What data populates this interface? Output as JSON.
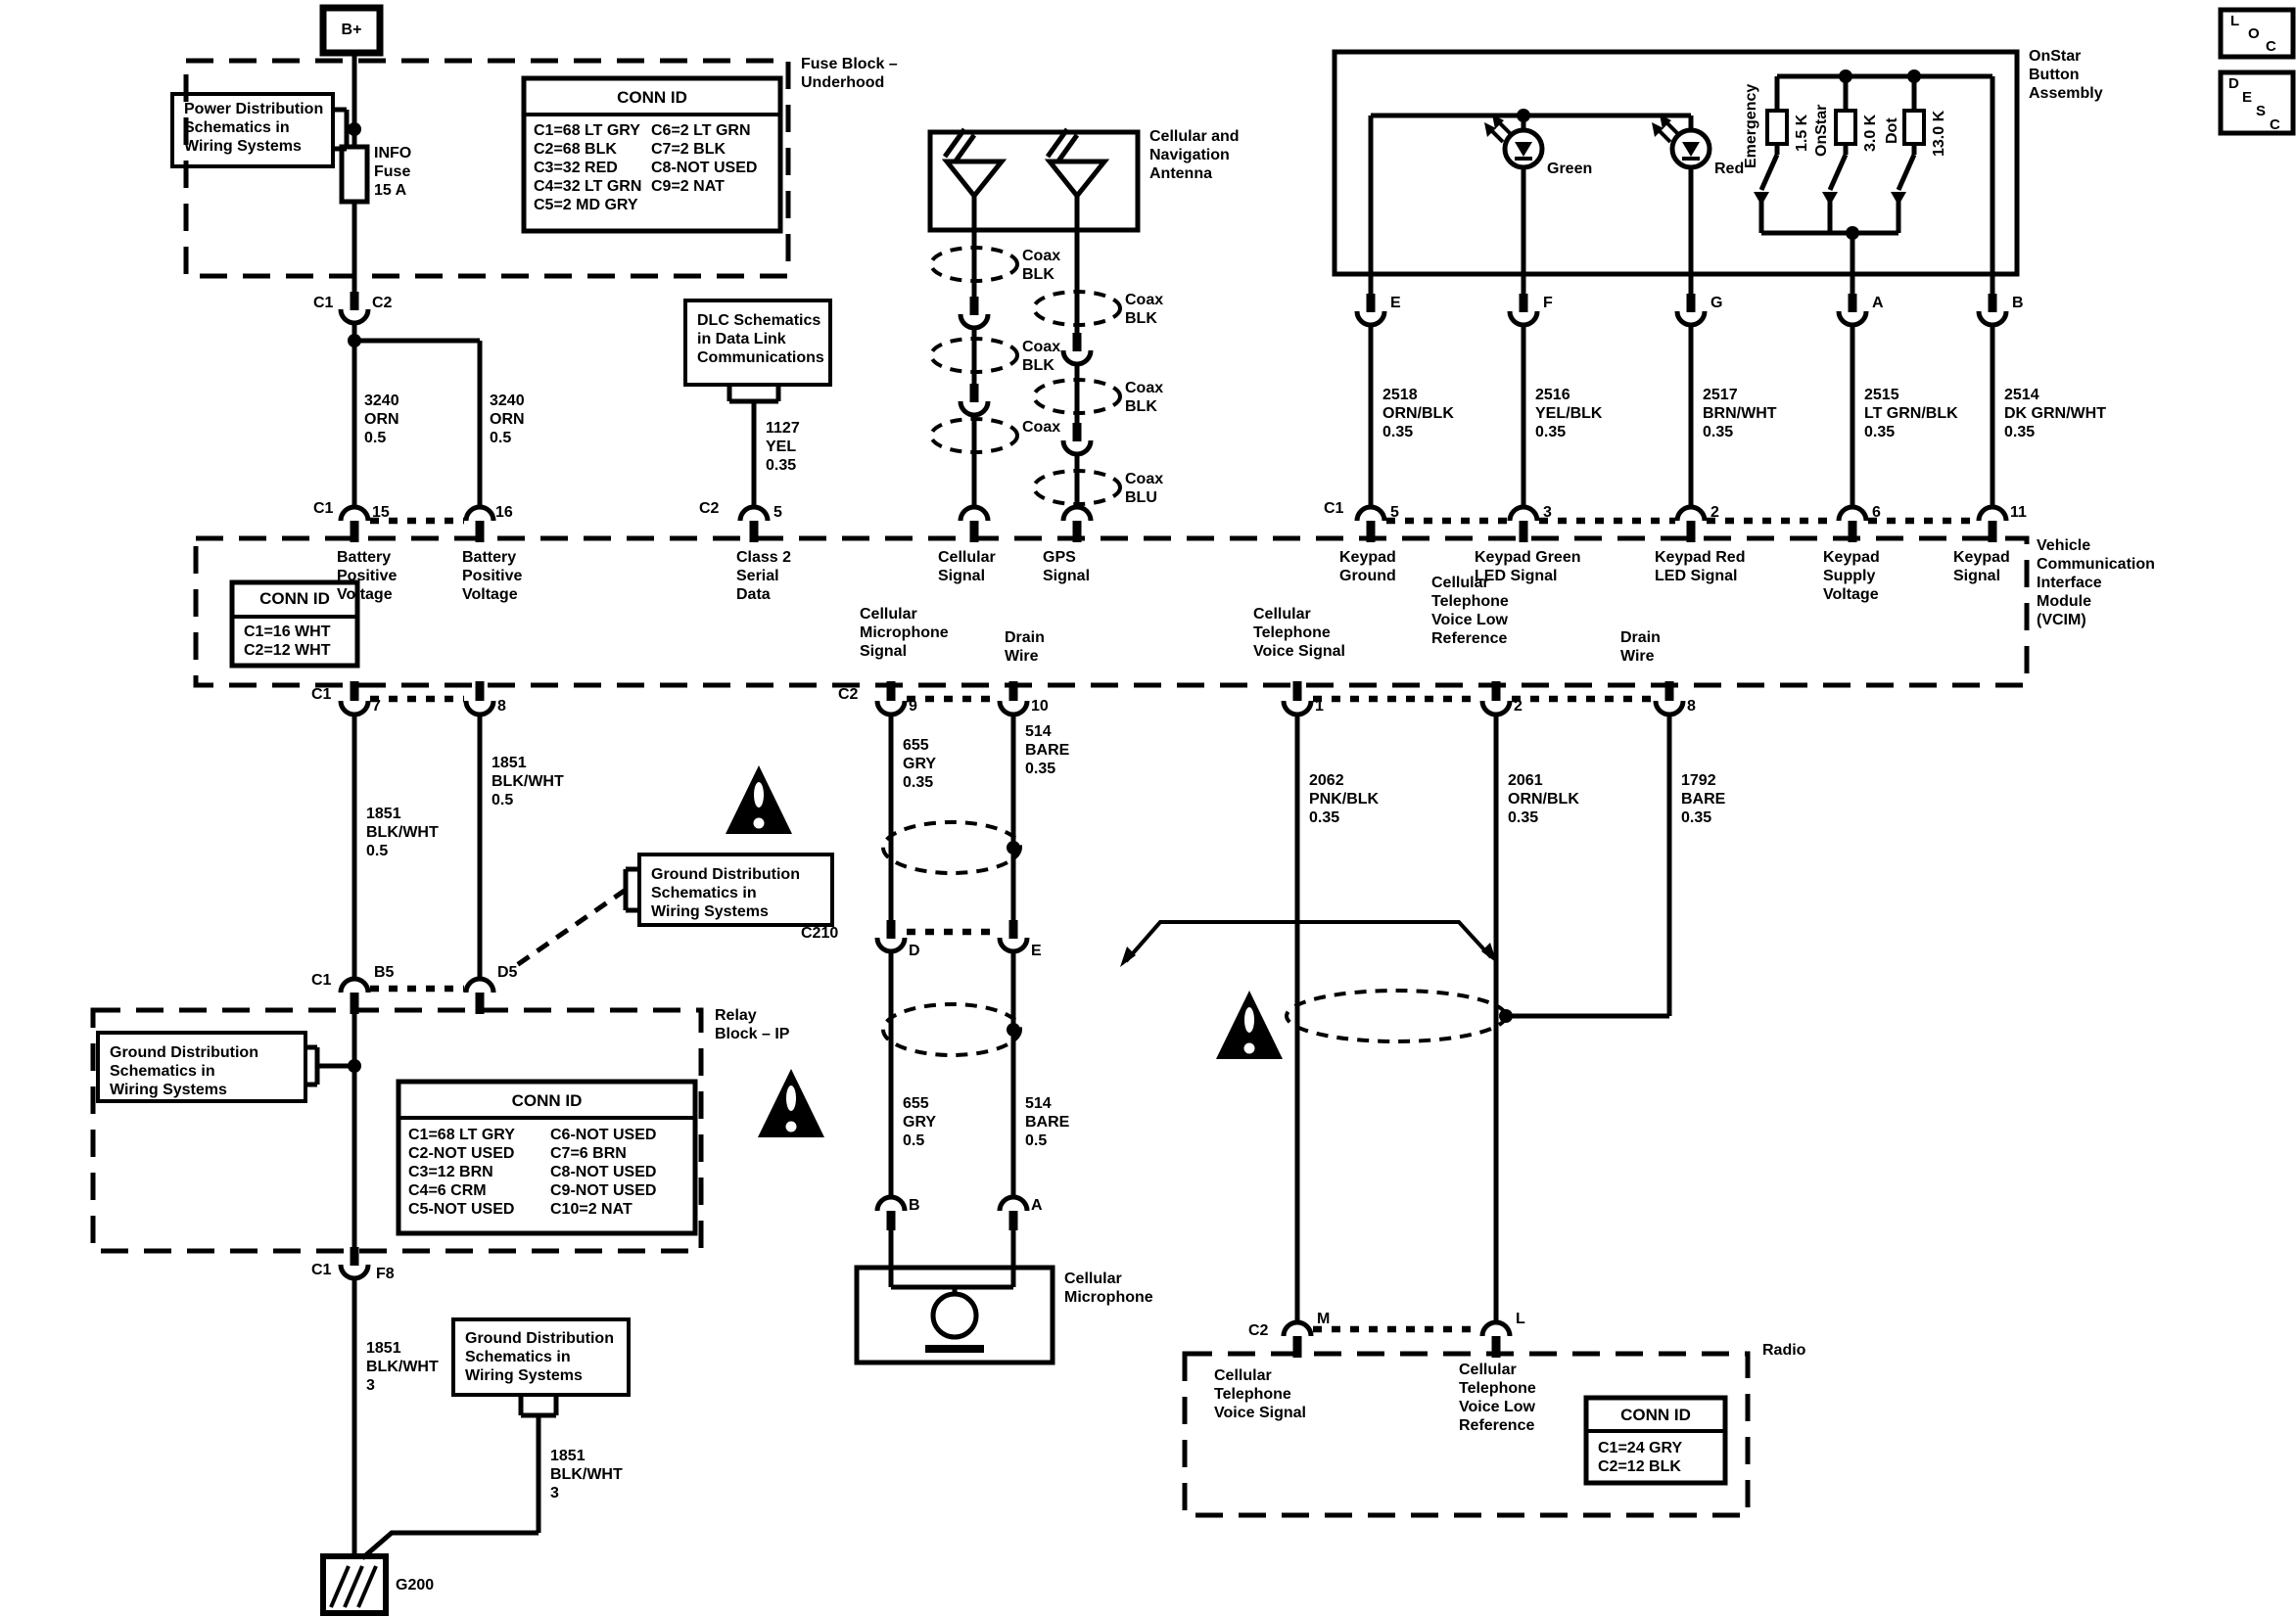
{
  "page": {
    "background": "#ffffff",
    "ink": "#000000"
  },
  "corner": {
    "loc": [
      "L",
      "O",
      "C"
    ],
    "desc": [
      "D",
      "E",
      "S",
      "C"
    ]
  },
  "battery": {
    "bplus": "B+",
    "power_note": [
      "Power Distribution",
      "Schematics in",
      "Wiring Systems"
    ],
    "fuse": [
      "INFO",
      "Fuse",
      "15 A"
    ],
    "fuse_block": [
      "Fuse Block –",
      "Underhood"
    ],
    "conn": {
      "title": "CONN ID",
      "col1": [
        "C1=68 LT GRY",
        "C2=68 BLK",
        "C3=32 RED",
        "C4=32 LT GRN",
        "C5=2 MD GRY"
      ],
      "col2": [
        "C6=2 LT GRN",
        "C7=2 BLK",
        "C8-NOT USED",
        "C9=2 NAT"
      ]
    },
    "c1": "C1",
    "c2": "C2",
    "wire_left": [
      "3240",
      "ORN",
      "0.5"
    ],
    "wire_right": [
      "3240",
      "ORN",
      "0.5"
    ]
  },
  "dlc": {
    "note": [
      "DLC Schematics",
      "in Data Link",
      "Communications"
    ],
    "wire": [
      "1127",
      "YEL",
      "0.35"
    ]
  },
  "antenna": {
    "title": [
      "Cellular and",
      "Navigation",
      "Antenna"
    ],
    "coax_left": [
      [
        "Coax",
        "BLK"
      ],
      [
        "Coax",
        "BLK"
      ],
      [
        "Coax"
      ]
    ],
    "coax_right": [
      [
        "Coax",
        "BLK"
      ],
      [
        "Coax",
        "BLK"
      ],
      [
        "Coax",
        "BLU"
      ]
    ]
  },
  "onstar": {
    "title": [
      "OnStar",
      "Button",
      "Assembly"
    ],
    "green": "Green",
    "red": "Red",
    "switches": [
      "Emergency",
      "OnStar",
      "Dot"
    ],
    "resistors": [
      "1.5 K",
      "3.0 K",
      "13.0 K"
    ],
    "pins": [
      "E",
      "F",
      "G",
      "A",
      "B"
    ],
    "wires": [
      [
        "2518",
        "ORN/BLK",
        "0.35"
      ],
      [
        "2516",
        "YEL/BLK",
        "0.35"
      ],
      [
        "2517",
        "BRN/WHT",
        "0.35"
      ],
      [
        "2515",
        "LT GRN/BLK",
        "0.35"
      ],
      [
        "2514",
        "DK GRN/WHT",
        "0.35"
      ]
    ]
  },
  "vcim": {
    "name": [
      "Vehicle",
      "Communication",
      "Interface",
      "Module",
      "(VCIM)"
    ],
    "conn": {
      "title": "CONN ID",
      "rows": [
        "C1=16 WHT",
        "C2=12 WHT"
      ]
    },
    "top_pins": {
      "c1a": "C1",
      "p15": "15",
      "p16": "16",
      "c2a": "C2",
      "p5": "5",
      "c1b": "C1",
      "p5b": "5",
      "p3": "3",
      "p2": "2",
      "p6": "6",
      "p11": "11"
    },
    "top_signals": {
      "batt1": [
        "Battery",
        "Positive",
        "Voltage"
      ],
      "batt2": [
        "Battery",
        "Positive",
        "Voltage"
      ],
      "class2": [
        "Class 2",
        "Serial",
        "Data"
      ],
      "cell": [
        "Cellular",
        "Signal"
      ],
      "gps": [
        "GPS",
        "Signal"
      ],
      "kground": [
        "Keypad",
        "Ground"
      ],
      "kgreen": [
        "Keypad Green",
        "LED Signal"
      ],
      "kred": [
        "Keypad Red",
        "LED Signal"
      ],
      "ksupply": [
        "Keypad",
        "Supply",
        "Voltage"
      ],
      "ksignal": [
        "Keypad",
        "Signal"
      ]
    },
    "bottom_pins": {
      "c1c": "C1",
      "p7": "7",
      "p8": "8",
      "c2b": "C2",
      "p9": "9",
      "p10": "10",
      "p1": "1",
      "p2b": "2",
      "p8b": "8"
    },
    "bottom_signals": {
      "micsig": [
        "Cellular",
        "Microphone",
        "Signal"
      ],
      "drain1": [
        "Drain",
        "Wire"
      ],
      "voicesig": [
        "Cellular",
        "Telephone",
        "Voice Signal"
      ],
      "voicelow": [
        "Cellular",
        "Telephone",
        "Voice Low",
        "Reference"
      ],
      "drain2": [
        "Drain",
        "Wire"
      ]
    }
  },
  "ground": {
    "wire_7": [
      "1851",
      "BLK/WHT",
      "0.5"
    ],
    "wire_8": [
      "1851",
      "BLK/WHT",
      "0.5"
    ],
    "note_mid": [
      "Ground Distribution",
      "Schematics in",
      "Wiring Systems"
    ],
    "c1d": "C1",
    "b5": "B5",
    "d5": "D5",
    "note_left": [
      "Ground Distribution",
      "Schematics in",
      "Wiring Systems"
    ],
    "relay": [
      "Relay",
      "Block – IP"
    ],
    "conn": {
      "title": "CONN ID",
      "col1": [
        "C1=68 LT GRY",
        "C2-NOT USED",
        "C3=12 BRN",
        "C4=6 CRM",
        "C5-NOT USED"
      ],
      "col2": [
        "C6-NOT USED",
        "C7=6 BRN",
        "C8-NOT USED",
        "C9-NOT USED",
        "C10=2 NAT"
      ]
    },
    "c1e": "C1",
    "f8": "F8",
    "wire_f8": [
      "1851",
      "BLK/WHT",
      "3"
    ],
    "note_bottom": [
      "Ground Distribution",
      "Schematics in",
      "Wiring Systems"
    ],
    "wire_note": [
      "1851",
      "BLK/WHT",
      "3"
    ],
    "g200": "G200"
  },
  "mic": {
    "wire_655a": [
      "655",
      "GRY",
      "0.35"
    ],
    "wire_514a": [
      "514",
      "BARE",
      "0.35"
    ],
    "c210": "C210",
    "d": "D",
    "e": "E",
    "wire_655b": [
      "655",
      "GRY",
      "0.5"
    ],
    "wire_514b": [
      "514",
      "BARE",
      "0.5"
    ],
    "b": "B",
    "a": "A",
    "title": [
      "Cellular",
      "Microphone"
    ]
  },
  "radio": {
    "wire_2062": [
      "2062",
      "PNK/BLK",
      "0.35"
    ],
    "wire_2061": [
      "2061",
      "ORN/BLK",
      "0.35"
    ],
    "wire_1792": [
      "1792",
      "BARE",
      "0.35"
    ],
    "c2c": "C2",
    "m": "M",
    "l": "L",
    "title": "Radio",
    "sig1": [
      "Cellular",
      "Telephone",
      "Voice Signal"
    ],
    "sig2": [
      "Cellular",
      "Telephone",
      "Voice Low",
      "Reference"
    ],
    "conn": {
      "title": "CONN ID",
      "rows": [
        "C1=24 GRY",
        "C2=12 BLK"
      ]
    }
  }
}
